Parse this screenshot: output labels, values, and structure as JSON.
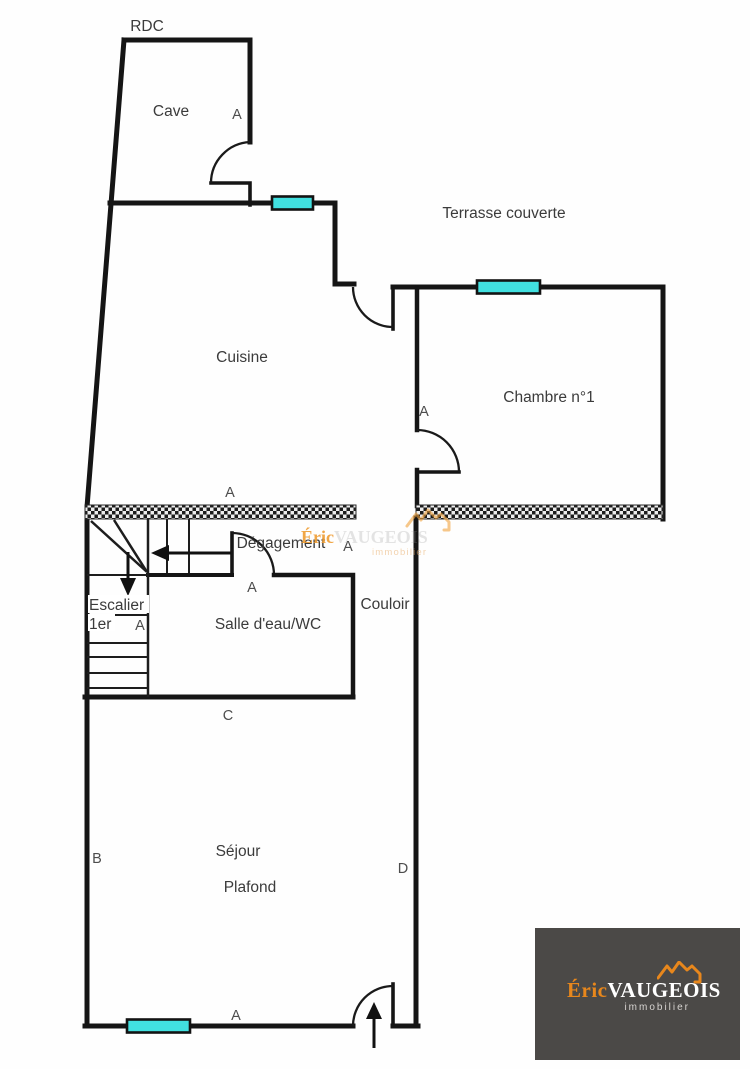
{
  "plan": {
    "floor_label": "RDC",
    "labels": {
      "cave": "Cave",
      "terrasse": "Terrasse couverte",
      "cuisine": "Cuisine",
      "chambre": "Chambre n°1",
      "degagement": "Dégagement",
      "salle_eau": "Salle d'eau/WC",
      "couloir": "Couloir",
      "escalier": "Escalier",
      "escalier_niveau": "1er",
      "sejour": "Séjour",
      "plafond": "Plafond"
    },
    "markers": {
      "a": "A",
      "b": "B",
      "c": "C",
      "d": "D"
    },
    "colors": {
      "wall": "#151515",
      "window_fill": "#41e0e0",
      "label_text": "#3b3b3b"
    }
  },
  "watermark": {
    "brand_first": "Éric",
    "brand_rest": "VAUGEOIS",
    "tagline": "immobilier"
  },
  "logo": {
    "brand_first": "Éric",
    "brand_rest": "VAUGEOIS",
    "tagline": "immobilier",
    "bg": "#4b4947",
    "orange": "#e8871c",
    "text": "#ffffff"
  }
}
